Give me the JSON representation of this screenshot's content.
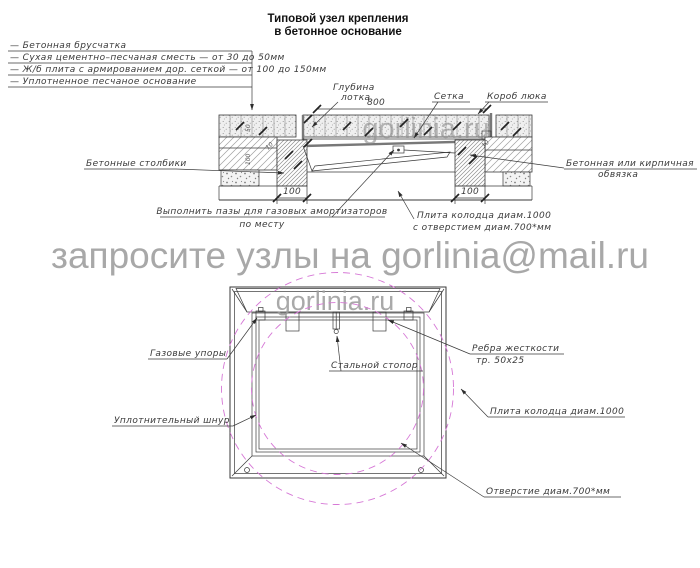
{
  "title": {
    "line1": "Типовой узел крепления",
    "line2": "в бетонное основание"
  },
  "watermarks": {
    "banner": "запросите узлы на gorlinia@mail.ru",
    "section": "gorlinia.ru",
    "plan": "gorlinia.ru"
  },
  "legend": {
    "items": [
      "—  Бетонная брусчатка",
      "—  Сухая цементно–песчаная сместь — от 30 до 50мм",
      "—  Ж/б плита с армированием дор. сеткой — от 100 до 150мм",
      "—  Уплотненное песчаное основание"
    ]
  },
  "section": {
    "labels": {
      "tray_depth_line1": "Глубина",
      "tray_depth_line2": "лотка",
      "mesh": "Сетка",
      "hatch_box": "Короб люка",
      "concrete_posts": "Бетонные столбики",
      "binding_line1": "Бетонная или кирпичная",
      "binding_line2": "обвязка",
      "grooves_line1": "Выполнить пазы для газовых амортизаторов",
      "grooves_line2": "по месту",
      "slab_line1": "Плита колодца диам.1000",
      "slab_line2": "с отверстием диам.700*мм"
    },
    "dims": {
      "width_800": "800",
      "left_100": "100",
      "right_100": "100",
      "gap_left_10": "10",
      "gap_right_10": "10",
      "layer_50": "50",
      "layer_100": "100"
    }
  },
  "plan": {
    "labels": {
      "gas_struts": "Газовые упоры",
      "steel_stopper": "Стальной стопор",
      "ribs_line1": "Ребра жесткости",
      "ribs_line2": "тр. 50х25",
      "well_slab": "Плита колодца диам.1000",
      "seal_cord": "Уплотнительный шнур",
      "opening": "Отверстие диам.700*мм"
    }
  },
  "colors": {
    "line": "#3a3a3a",
    "hatch": "#9a9a9a",
    "accent_magenta": "#d678d6",
    "watermark_gray": "#a8a8a8"
  }
}
